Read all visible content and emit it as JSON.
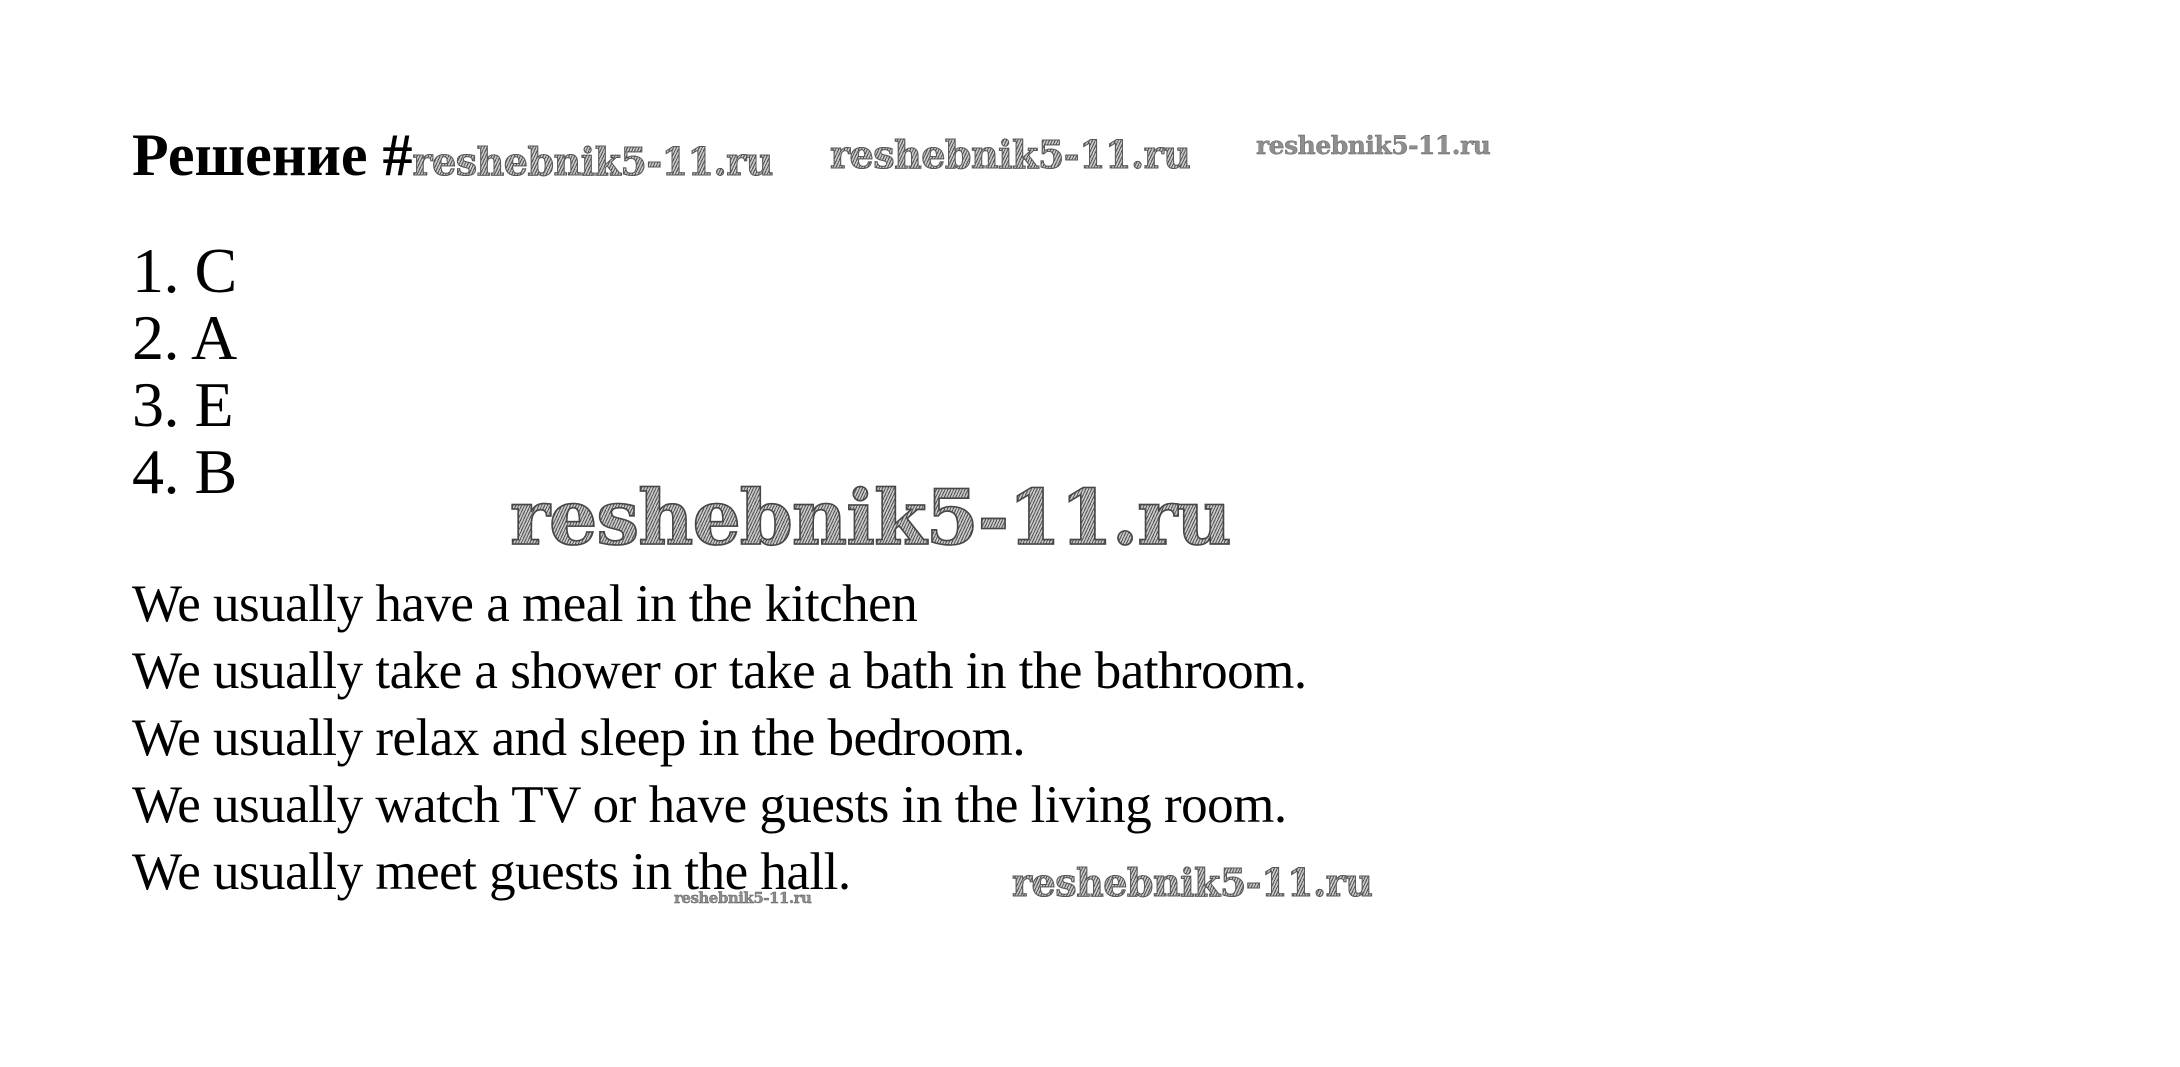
{
  "page": {
    "background": "#ffffff",
    "text_color": "#000000",
    "watermark_color": "#6e6e6e"
  },
  "title": {
    "label": "Решение #"
  },
  "watermarks": {
    "after_title": "reshebnik5-11.ru",
    "top_center": "reshebnik5-11.ru",
    "top_right": "reshebnik5-11.ru",
    "center_large": "reshebnik5-11.ru",
    "bottom_small": "reshebnik5-11.ru",
    "bottom_right": "reshebnik5-11.ru"
  },
  "answers": {
    "items": [
      "1. C",
      "2. A",
      "3. E",
      "4. B"
    ]
  },
  "sentences": {
    "lines": [
      "We usually have a meal in the kitchen",
      "We usually take a shower or take a bath in the bathroom.",
      "We usually relax and sleep in the bedroom.",
      "We usually watch TV or have guests in the living room.",
      "We usually meet guests in the hall."
    ]
  }
}
